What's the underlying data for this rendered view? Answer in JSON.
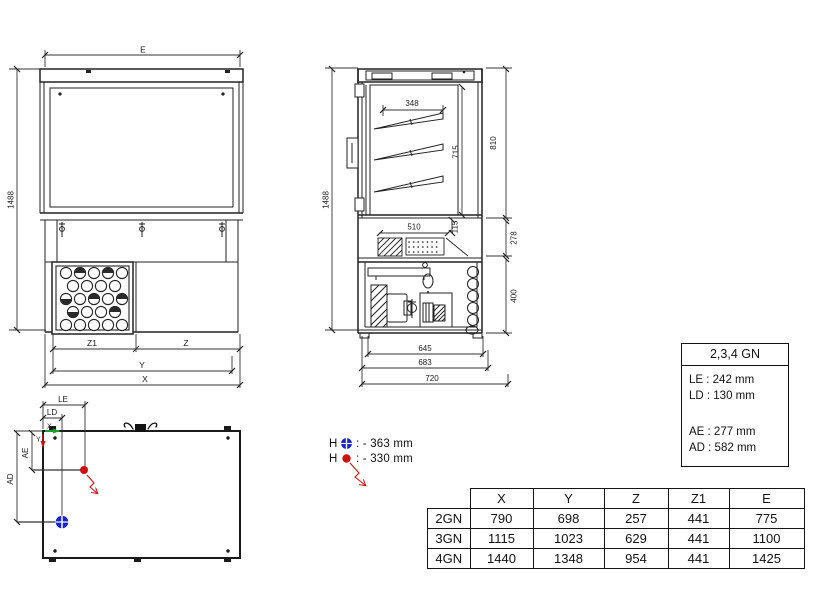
{
  "front_view": {
    "dim_width_top": "E",
    "dim_height": "1488",
    "dim_z1": "Z1",
    "dim_z": "Z",
    "dim_y": "Y",
    "dim_x": "X"
  },
  "side_view": {
    "dim_height": "1488",
    "dim_shelf_width": "348",
    "dim_inner_height": "715",
    "dim_display_height": "810",
    "dim_well_width": "510",
    "dim_well_depth": "115",
    "dim_mid_height": "278",
    "dim_base_height": "400",
    "dim_depth_inner": "645",
    "dim_depth_mid": "683",
    "dim_depth_total": "720"
  },
  "top_view": {
    "dim_le": "LE",
    "dim_ld": "LD",
    "axis_x": "X",
    "axis_y": "Y",
    "dim_ae": "AE",
    "dim_ad": "AD"
  },
  "legend": {
    "blue_label": "H",
    "blue_value": ": - 363 mm",
    "red_label": "H",
    "red_value": ": - 330 mm"
  },
  "info_box": {
    "title": "2,3,4 GN",
    "rows": [
      "LE : 242 mm",
      "LD : 130 mm",
      "AE : 277 mm",
      "AD : 582 mm"
    ]
  },
  "spec_table": {
    "headers": [
      "X",
      "Y",
      "Z",
      "Z1",
      "E"
    ],
    "rows": [
      {
        "label": "2GN",
        "values": [
          "790",
          "698",
          "257",
          "441",
          "775"
        ]
      },
      {
        "label": "3GN",
        "values": [
          "1115",
          "1023",
          "629",
          "441",
          "1100"
        ]
      },
      {
        "label": "4GN",
        "values": [
          "1440",
          "1348",
          "954",
          "441",
          "1425"
        ]
      }
    ]
  },
  "colors": {
    "marker_blue": "#1822cf",
    "marker_red": "#cf1010",
    "axis_green": "#15a02a",
    "line": "#222222"
  }
}
